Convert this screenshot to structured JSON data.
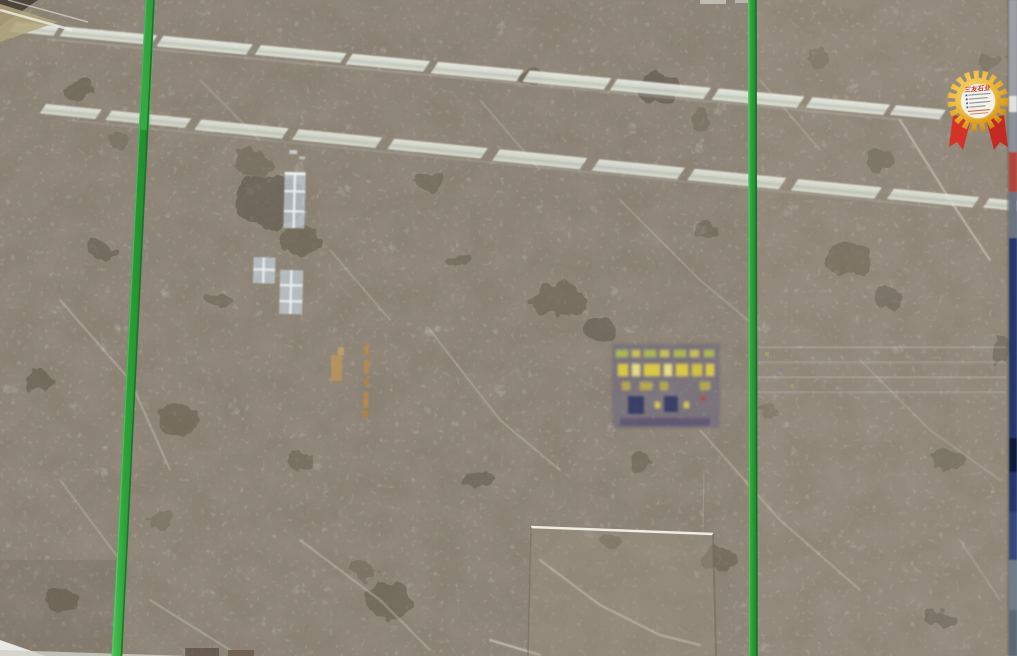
{
  "photo": {
    "subject": "Polished grey-brown breccia marble slabs in a stone showroom",
    "details": "Three large slabs bound with green packing straps, ceiling light reflections crossing the polished surface, small slab leaning at bottom center, gold award rosette sticker at top right"
  },
  "badge": {
    "title": "三友石业",
    "kind": "gold rosette quality label with red ribbons and handwritten spec lines"
  },
  "straps": {
    "count": 2,
    "color": "#2fa23c"
  },
  "palette": {
    "stone_base": "#8b8274",
    "stone_dark_blotch": "#5e5546",
    "stone_vein": "#ddd6c8",
    "light_band": "#e3e7dc",
    "strap_green": "#2fa23c",
    "strap_green_dark": "#1c7227",
    "edge_navy": "#24386a",
    "edge_grey": "#9aa0a6",
    "badge_gold": "#e3a226",
    "ribbon_red": "#d43328",
    "window_reflection_blue": "#c9d4de",
    "sign_reflection_purple": "#5c5380",
    "sign_reflection_yellow": "#e3d23f",
    "orange_reflection": "#c08a45",
    "floor_white": "#e8e8e4"
  }
}
